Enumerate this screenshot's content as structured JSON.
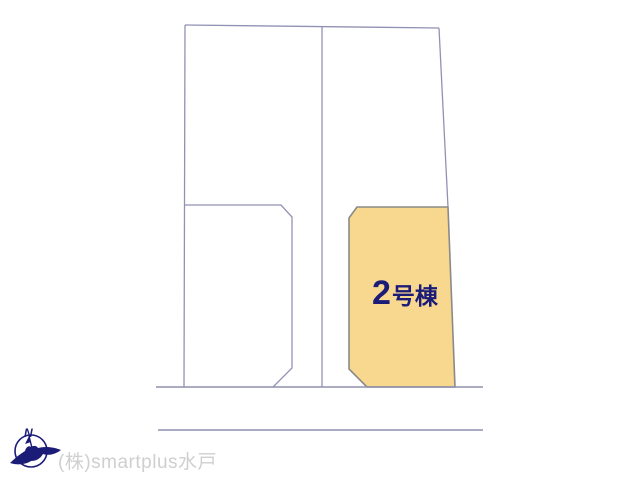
{
  "diagram": {
    "kind": "land-plot-layout",
    "outline_color": "#9191b3",
    "road_line_color": "#8f8fae"
  },
  "parcels": {
    "highlighted": {
      "label_number": "2",
      "label_suffix": "号棟",
      "fill": "#f8d78f",
      "stroke": "#8a8a8a",
      "label_color": "#1b1b78"
    }
  },
  "compass": {
    "label": "N",
    "color": "#1b1b78"
  },
  "watermark": {
    "text": "(株)smartplus水戸",
    "color": "#cfcfcf"
  }
}
